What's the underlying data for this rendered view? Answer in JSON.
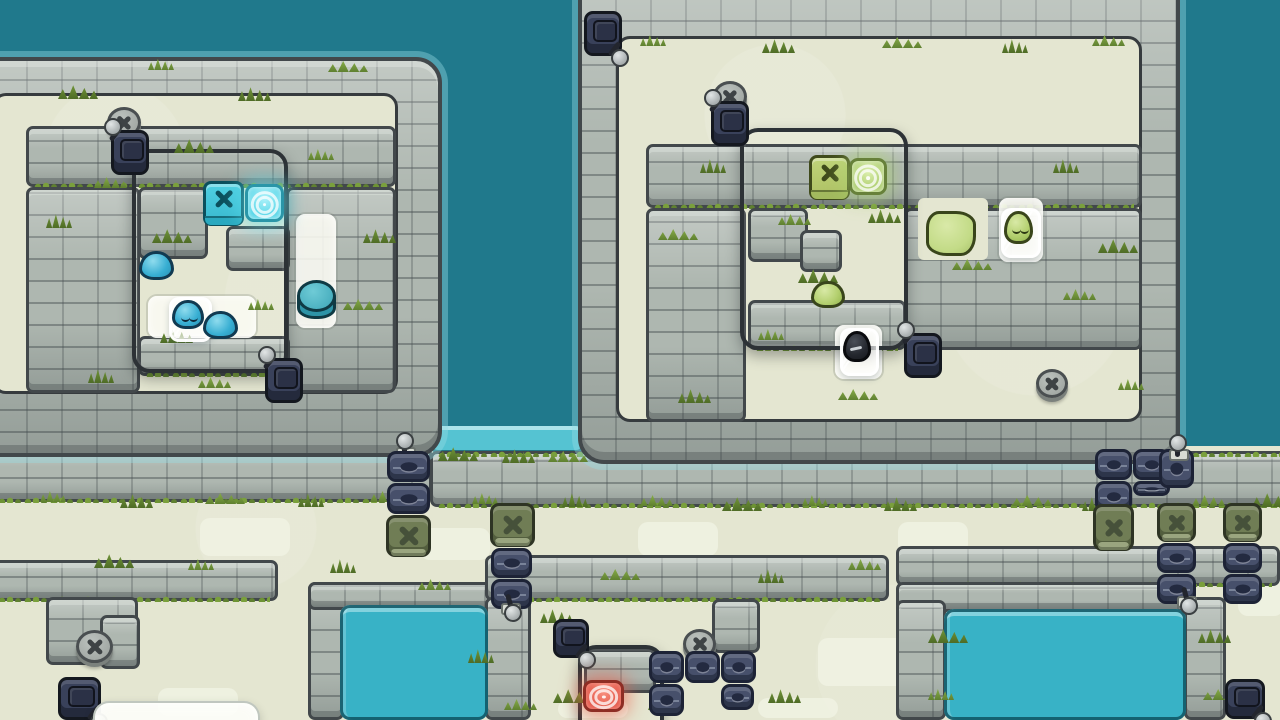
{
  "scene": {
    "title": "Stone ruins tile puzzle level - two walled islands with slimes, gates, levers and buttons",
    "canvas": {
      "w": 1280,
      "h": 720
    }
  },
  "palette": {
    "ocean": "#20798C",
    "ground": "#E4E6D1",
    "ground_patch": "#F0F2E3",
    "stone": "#AEB7B0",
    "stone_outline": "#42484B",
    "grass_light": "#7AA03C",
    "grass_dark": "#5F8030",
    "subroom_outline": "#2D3236",
    "pool_water": "#38B2C6",
    "pool_lap": "#55C3D2",
    "pool_rim": "#0E5462",
    "lane_white": "#FAFBF3",
    "cube_teal": "#41C4D9",
    "cube_teal_edge": "#0B4F5C",
    "pad_teal": "#57D6E8",
    "blob_blue": "#37AED2",
    "cube_green": "#B6CB6D",
    "cube_green_edge": "#3F4A1B",
    "pad_green": "#9FC75D",
    "blob_green": "#B3CF6E",
    "blob_black": "#24272E",
    "pad_red": "#E4584A",
    "gate_navy": "#47506B",
    "gate_navy_edge": "#1D2336",
    "gate_olive": "#707D55",
    "gate_olive_edge": "#2E3424",
    "disc_grey": "#A8AEAB",
    "disc_edge": "#4A4F51",
    "switch_navy": "#39415A",
    "lever_ball": "#C9CFCF",
    "ice_white": "#FFFFFF",
    "panel_white": "#FCFDF8"
  },
  "icons": {
    "x-mark": "✕",
    "lever": "lever-handle",
    "target-pad": "concentric-rings"
  },
  "terrain": {
    "blocks": [
      {
        "k": "ocean",
        "x": 0,
        "y": 0,
        "w": 1280,
        "h": 720
      },
      {
        "k": "ground",
        "x": 0,
        "y": 446,
        "w": 1280,
        "h": 274
      },
      {
        "k": "patch",
        "x": 200,
        "y": 518,
        "w": 90,
        "h": 38
      },
      {
        "k": "patch",
        "x": 420,
        "y": 528,
        "w": 70,
        "h": 32
      },
      {
        "k": "patch",
        "x": 638,
        "y": 522,
        "w": 80,
        "h": 34
      },
      {
        "k": "patch",
        "x": 898,
        "y": 522,
        "w": 70,
        "h": 32
      },
      {
        "k": "patch",
        "x": 1238,
        "y": 556,
        "w": 46,
        "h": 60
      },
      {
        "k": "patch",
        "x": 158,
        "y": 688,
        "w": 80,
        "h": 28
      },
      {
        "k": "patch",
        "x": 428,
        "y": 688,
        "w": 90,
        "h": 28
      },
      {
        "k": "patch",
        "x": 558,
        "y": 700,
        "w": 70,
        "h": 18
      },
      {
        "k": "patch",
        "x": 818,
        "y": 638,
        "w": 92,
        "h": 48
      },
      {
        "k": "patch",
        "x": 1002,
        "y": 556,
        "w": 60,
        "h": 28
      },
      {
        "k": "patch",
        "x": 758,
        "y": 698,
        "w": 80,
        "h": 20
      },
      {
        "k": "pool",
        "v": "lap",
        "x": 432,
        "y": 426,
        "w": 150,
        "h": 28
      },
      {
        "k": "band",
        "x": -10,
        "y": 447,
        "w": 442,
        "h": 55,
        "g": 1
      },
      {
        "k": "band",
        "x": 430,
        "y": 451,
        "w": 860,
        "h": 56,
        "g": 1,
        "gt": 1
      },
      {
        "k": "band",
        "x": -10,
        "y": 560,
        "w": 288,
        "h": 41,
        "g": 1
      },
      {
        "k": "wall",
        "x": 46,
        "y": 597,
        "w": 92,
        "h": 68
      },
      {
        "k": "wall",
        "x": 100,
        "y": 615,
        "w": 40,
        "h": 54
      },
      {
        "k": "wall",
        "x": 308,
        "y": 582,
        "w": 36,
        "h": 138
      },
      {
        "k": "wall",
        "x": 308,
        "y": 582,
        "w": 196,
        "h": 28
      },
      {
        "k": "band",
        "x": 485,
        "y": 555,
        "w": 404,
        "h": 46,
        "g": 1
      },
      {
        "k": "wall",
        "x": 485,
        "y": 597,
        "w": 46,
        "h": 123
      },
      {
        "k": "wall",
        "x": 712,
        "y": 599,
        "w": 48,
        "h": 54
      },
      {
        "k": "band",
        "x": 896,
        "y": 546,
        "w": 384,
        "h": 40,
        "g": 1
      },
      {
        "k": "wall",
        "x": 896,
        "y": 582,
        "w": 298,
        "h": 30
      },
      {
        "k": "wall",
        "x": 896,
        "y": 600,
        "w": 50,
        "h": 120
      },
      {
        "k": "wall",
        "x": 1184,
        "y": 597,
        "w": 42,
        "h": 123
      },
      {
        "k": "pool",
        "x": 340,
        "y": 605,
        "w": 148,
        "h": 115
      },
      {
        "k": "pool",
        "x": 944,
        "y": 609,
        "w": 242,
        "h": 111
      },
      {
        "k": "isle",
        "x": -46,
        "y": 57,
        "w": 488,
        "h": 400
      },
      {
        "k": "iground",
        "x": -8,
        "y": 93,
        "w": 406,
        "h": 301
      },
      {
        "k": "wall",
        "x": 26,
        "y": 126,
        "w": 370,
        "h": 61,
        "g": 1
      },
      {
        "k": "wall",
        "x": 26,
        "y": 187,
        "w": 114,
        "h": 206
      },
      {
        "k": "wall",
        "x": 286,
        "y": 187,
        "w": 110,
        "h": 206
      },
      {
        "k": "wall",
        "x": 138,
        "y": 187,
        "w": 70,
        "h": 72
      },
      {
        "k": "wall",
        "x": 226,
        "y": 226,
        "w": 64,
        "h": 45
      },
      {
        "k": "wall",
        "x": 138,
        "y": 336,
        "w": 152,
        "h": 40,
        "g": 1
      },
      {
        "k": "lane",
        "x": 148,
        "y": 296,
        "w": 108,
        "h": 42
      },
      {
        "k": "lane",
        "x": 296,
        "y": 214,
        "w": 40,
        "h": 114
      },
      {
        "k": "isle",
        "x": 578,
        "y": -32,
        "w": 602,
        "h": 496
      },
      {
        "k": "iground",
        "x": 616,
        "y": 36,
        "w": 526,
        "h": 386
      },
      {
        "k": "wall",
        "x": 646,
        "y": 144,
        "w": 496,
        "h": 64,
        "g": 1
      },
      {
        "k": "wall",
        "x": 646,
        "y": 208,
        "w": 100,
        "h": 214
      },
      {
        "k": "wall",
        "x": 904,
        "y": 208,
        "w": 238,
        "h": 142
      },
      {
        "k": "cream",
        "x": 918,
        "y": 198,
        "w": 70,
        "h": 62
      },
      {
        "k": "wall",
        "x": 748,
        "y": 208,
        "w": 60,
        "h": 54
      },
      {
        "k": "wall",
        "x": 800,
        "y": 230,
        "w": 42,
        "h": 42
      },
      {
        "k": "wall",
        "x": 748,
        "y": 300,
        "w": 158,
        "h": 50,
        "g": 1
      },
      {
        "k": "lane",
        "x": 999,
        "y": 198,
        "w": 44,
        "h": 64
      },
      {
        "k": "lane",
        "x": 835,
        "y": 325,
        "w": 47,
        "h": 54
      },
      {
        "k": "wall",
        "x": 584,
        "y": 649,
        "w": 72,
        "h": 44
      },
      {
        "k": "subroom",
        "x": 132,
        "y": 149,
        "w": 156,
        "h": 224
      },
      {
        "k": "subroom",
        "x": 740,
        "y": 128,
        "w": 168,
        "h": 222
      },
      {
        "k": "subroom",
        "x": 578,
        "y": 645,
        "w": 86,
        "h": 110
      }
    ],
    "grass": [
      [
        40,
        490
      ],
      [
        120,
        493
      ],
      [
        205,
        492
      ],
      [
        298,
        492
      ],
      [
        370,
        490
      ],
      [
        438,
        446
      ],
      [
        472,
        492
      ],
      [
        502,
        448
      ],
      [
        548,
        450
      ],
      [
        562,
        492
      ],
      [
        640,
        494
      ],
      [
        722,
        496
      ],
      [
        802,
        494
      ],
      [
        884,
        496
      ],
      [
        1012,
        494
      ],
      [
        1082,
        496
      ],
      [
        1192,
        494
      ],
      [
        1252,
        492
      ],
      [
        640,
        34
      ],
      [
        762,
        38
      ],
      [
        882,
        36
      ],
      [
        1002,
        38
      ],
      [
        1092,
        34
      ],
      [
        58,
        84
      ],
      [
        148,
        58
      ],
      [
        238,
        86
      ],
      [
        328,
        60
      ],
      [
        46,
        213
      ],
      [
        94,
        176
      ],
      [
        174,
        138
      ],
      [
        308,
        148
      ],
      [
        363,
        228
      ],
      [
        343,
        298
      ],
      [
        88,
        368
      ],
      [
        198,
        376
      ],
      [
        152,
        228
      ],
      [
        248,
        298
      ],
      [
        160,
        328
      ],
      [
        658,
        228
      ],
      [
        700,
        158
      ],
      [
        778,
        213
      ],
      [
        798,
        268
      ],
      [
        758,
        328
      ],
      [
        868,
        208
      ],
      [
        952,
        258
      ],
      [
        1053,
        158
      ],
      [
        1063,
        288
      ],
      [
        1098,
        238
      ],
      [
        1118,
        378
      ],
      [
        678,
        388
      ],
      [
        838,
        388
      ],
      [
        330,
        558
      ],
      [
        418,
        578
      ],
      [
        94,
        553
      ],
      [
        188,
        558
      ],
      [
        540,
        608
      ],
      [
        600,
        568
      ],
      [
        758,
        568
      ],
      [
        848,
        558
      ],
      [
        928,
        628
      ],
      [
        928,
        688
      ],
      [
        1198,
        628
      ],
      [
        1203,
        688
      ],
      [
        468,
        648
      ],
      [
        504,
        698
      ],
      [
        553,
        688
      ],
      [
        648,
        698
      ],
      [
        768,
        688
      ]
    ]
  },
  "entities": [
    {
      "t": "xdisc",
      "x": 107,
      "y": 107,
      "w": 34,
      "h": 31
    },
    {
      "t": "switch",
      "x": 111,
      "y": 130,
      "w": 38,
      "h": 45,
      "lv": "tl"
    },
    {
      "t": "cube",
      "v": "teal",
      "x": 203,
      "y": 181,
      "w": 41,
      "h": 45
    },
    {
      "t": "pad",
      "v": "teal",
      "x": 245,
      "y": 184,
      "w": 39,
      "h": 38
    },
    {
      "t": "blob",
      "v": "blue",
      "x": 139,
      "y": 251,
      "w": 35,
      "h": 29
    },
    {
      "t": "ice",
      "v": "blue",
      "s": 1,
      "x": 169,
      "y": 297,
      "w": 43,
      "h": 45
    },
    {
      "t": "blob",
      "v": "blue",
      "x": 203,
      "y": 311,
      "w": 35,
      "h": 28
    },
    {
      "t": "cyl",
      "x": 297,
      "y": 280,
      "w": 39,
      "h": 39
    },
    {
      "t": "switch",
      "x": 265,
      "y": 358,
      "w": 38,
      "h": 45,
      "lv": "tl"
    },
    {
      "t": "lever",
      "v": "u",
      "x": 393,
      "y": 436,
      "w": 22,
      "h": 24
    },
    {
      "t": "gate",
      "v": "navy",
      "x": 387,
      "y": 451,
      "w": 43,
      "h": 31
    },
    {
      "t": "gate",
      "v": "navy",
      "x": 387,
      "y": 483,
      "w": 43,
      "h": 31
    },
    {
      "t": "gate",
      "v": "olive",
      "x": 386,
      "y": 515,
      "w": 45,
      "h": 42
    },
    {
      "t": "switch",
      "x": 584,
      "y": 11,
      "w": 38,
      "h": 45,
      "lv": "br"
    },
    {
      "t": "xdisc",
      "x": 713,
      "y": 81,
      "w": 34,
      "h": 31
    },
    {
      "t": "switch",
      "x": 711,
      "y": 101,
      "w": 38,
      "h": 45,
      "lv": "tl"
    },
    {
      "t": "cube",
      "v": "green",
      "x": 809,
      "y": 155,
      "w": 41,
      "h": 45
    },
    {
      "t": "pad",
      "v": "green",
      "x": 849,
      "y": 158,
      "w": 38,
      "h": 37
    },
    {
      "t": "blob",
      "v": "green",
      "x": 811,
      "y": 281,
      "w": 34,
      "h": 27
    },
    {
      "t": "poly",
      "x": 926,
      "y": 211,
      "w": 50,
      "h": 45
    },
    {
      "t": "ice",
      "v": "green",
      "s": 1,
      "x": 1001,
      "y": 208,
      "w": 40,
      "h": 50
    },
    {
      "t": "ice",
      "v": "black",
      "x": 840,
      "y": 328,
      "w": 39,
      "h": 48
    },
    {
      "t": "switch",
      "x": 904,
      "y": 333,
      "w": 38,
      "h": 45,
      "lv": "tl"
    },
    {
      "t": "xdisc",
      "x": 1036,
      "y": 369,
      "w": 32,
      "h": 29
    },
    {
      "t": "gate",
      "v": "olive",
      "x": 490,
      "y": 503,
      "w": 45,
      "h": 44
    },
    {
      "t": "gate",
      "v": "navy",
      "x": 491,
      "y": 548,
      "w": 41,
      "h": 30
    },
    {
      "t": "gate",
      "v": "navy",
      "x": 491,
      "y": 579,
      "w": 41,
      "h": 30
    },
    {
      "t": "lever",
      "v": "d",
      "x": 498,
      "y": 592,
      "w": 22,
      "h": 24
    },
    {
      "t": "switch",
      "x": 553,
      "y": 619,
      "w": 36,
      "h": 39,
      "lv": "br"
    },
    {
      "t": "xdisc",
      "x": 683,
      "y": 629,
      "w": 33,
      "h": 30
    },
    {
      "t": "gate",
      "v": "navy",
      "x": 649,
      "y": 651,
      "w": 35,
      "h": 32
    },
    {
      "t": "gate",
      "v": "navy",
      "x": 685,
      "y": 651,
      "w": 35,
      "h": 32
    },
    {
      "t": "gate",
      "v": "navy",
      "x": 721,
      "y": 651,
      "w": 35,
      "h": 32
    },
    {
      "t": "gate",
      "v": "navy",
      "x": 649,
      "y": 684,
      "w": 35,
      "h": 32
    },
    {
      "t": "gate",
      "v": "navy",
      "x": 721,
      "y": 684,
      "w": 33,
      "h": 26
    },
    {
      "t": "pad",
      "v": "red",
      "x": 583,
      "y": 680,
      "w": 41,
      "h": 32
    },
    {
      "t": "xdisc",
      "x": 76,
      "y": 630,
      "w": 37,
      "h": 33
    },
    {
      "t": "switch",
      "x": 58,
      "y": 677,
      "w": 43,
      "h": 43,
      "lv": "br"
    },
    {
      "t": "panel",
      "x": 93,
      "y": 701,
      "w": 167,
      "h": 42
    },
    {
      "t": "gate",
      "v": "navy",
      "x": 1095,
      "y": 449,
      "w": 37,
      "h": 31
    },
    {
      "t": "gate",
      "v": "navy",
      "x": 1133,
      "y": 449,
      "w": 37,
      "h": 31
    },
    {
      "t": "gate",
      "v": "navy",
      "x": 1095,
      "y": 481,
      "w": 37,
      "h": 31
    },
    {
      "t": "gate",
      "v": "navy",
      "x": 1133,
      "y": 481,
      "w": 37,
      "h": 15
    },
    {
      "t": "gate",
      "v": "navy",
      "x": 1159,
      "y": 449,
      "w": 35,
      "h": 39
    },
    {
      "t": "lever",
      "v": "u",
      "x": 1166,
      "y": 438,
      "w": 22,
      "h": 24
    },
    {
      "t": "gate",
      "v": "olive",
      "x": 1093,
      "y": 504,
      "w": 41,
      "h": 47
    },
    {
      "t": "gate",
      "v": "olive",
      "x": 1157,
      "y": 503,
      "w": 39,
      "h": 39
    },
    {
      "t": "gate",
      "v": "olive",
      "x": 1223,
      "y": 503,
      "w": 39,
      "h": 39
    },
    {
      "t": "gate",
      "v": "navy",
      "x": 1157,
      "y": 543,
      "w": 39,
      "h": 30
    },
    {
      "t": "gate",
      "v": "navy",
      "x": 1157,
      "y": 574,
      "w": 39,
      "h": 30
    },
    {
      "t": "gate",
      "v": "navy",
      "x": 1223,
      "y": 543,
      "w": 39,
      "h": 30
    },
    {
      "t": "gate",
      "v": "navy",
      "x": 1223,
      "y": 574,
      "w": 39,
      "h": 30
    },
    {
      "t": "lever",
      "v": "d",
      "x": 1174,
      "y": 585,
      "w": 22,
      "h": 24
    },
    {
      "t": "switch",
      "x": 1225,
      "y": 679,
      "w": 40,
      "h": 40,
      "lv": "br"
    }
  ]
}
